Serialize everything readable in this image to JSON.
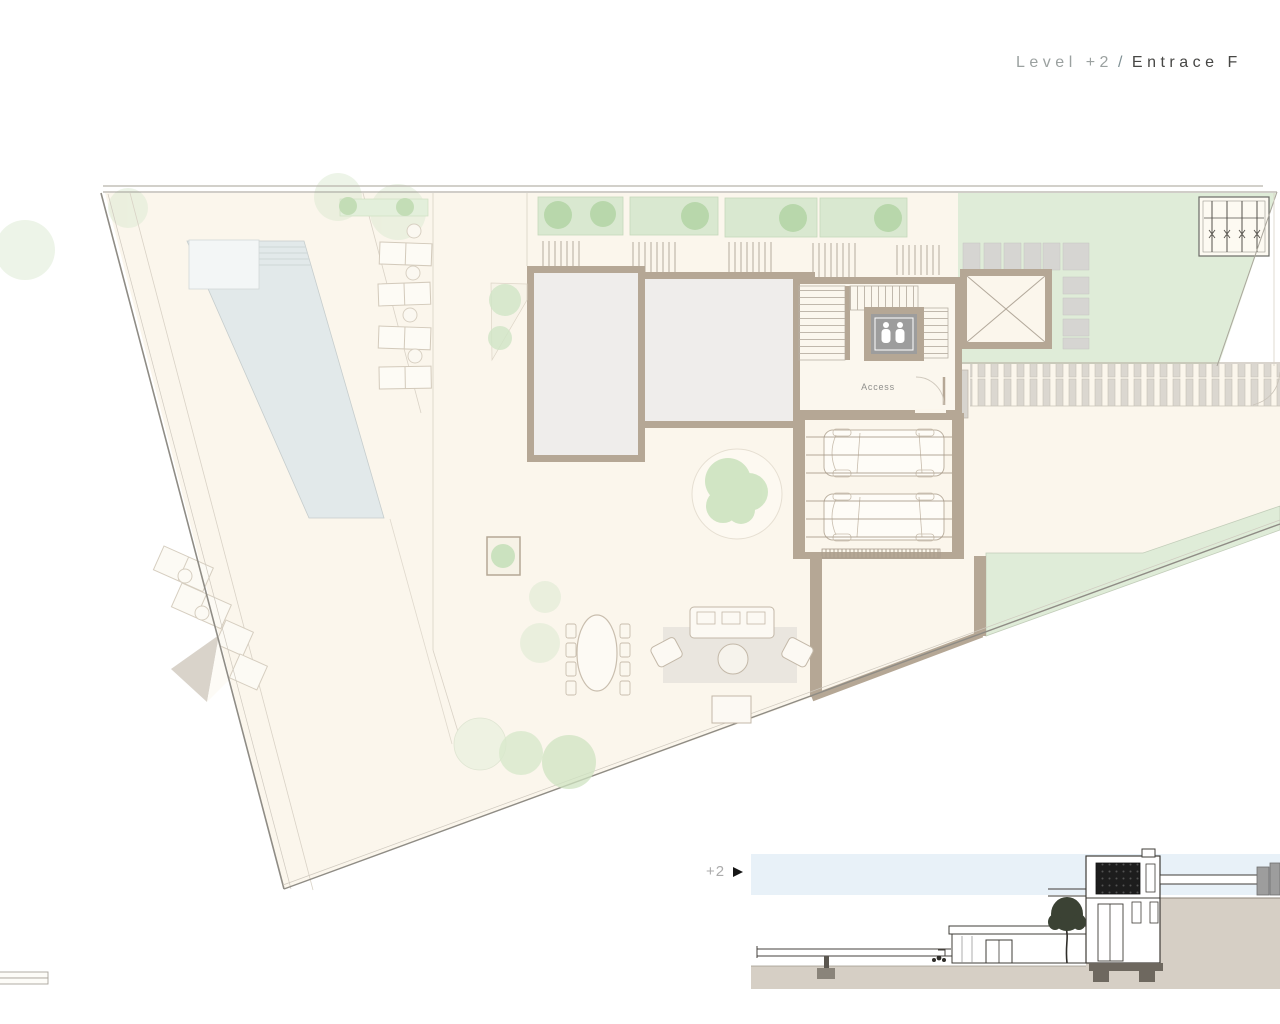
{
  "header": {
    "level_label": "Level +2",
    "separator": "/",
    "floor_label": "Entrace F"
  },
  "plan": {
    "access_label": "Access"
  },
  "section": {
    "marker_label": "+2"
  },
  "icons": {
    "level_marker_arrow": "right-triangle",
    "elevator": "elevator-people-icon",
    "void_cross": "x-cross",
    "door_swing": "quarter-arc"
  },
  "colors": {
    "site_fill": "#fbf6ec",
    "wall_tan": "#b5a795",
    "room_fill": "#efedeb",
    "pool_blue": "#e3eaeb",
    "lawn_green": "#dfecd8",
    "planter_green": "#d9e8d0",
    "bush_green": "#b8d7ab",
    "paver_gray": "#d6d5d2",
    "section_sky": "#e8f1f8",
    "section_ground": "#d6cfc5",
    "line_dark": "#3f3c37",
    "boundary_gray": "#8f8c85",
    "title_gray": "#9ba1a0",
    "title_dark": "#474745"
  }
}
